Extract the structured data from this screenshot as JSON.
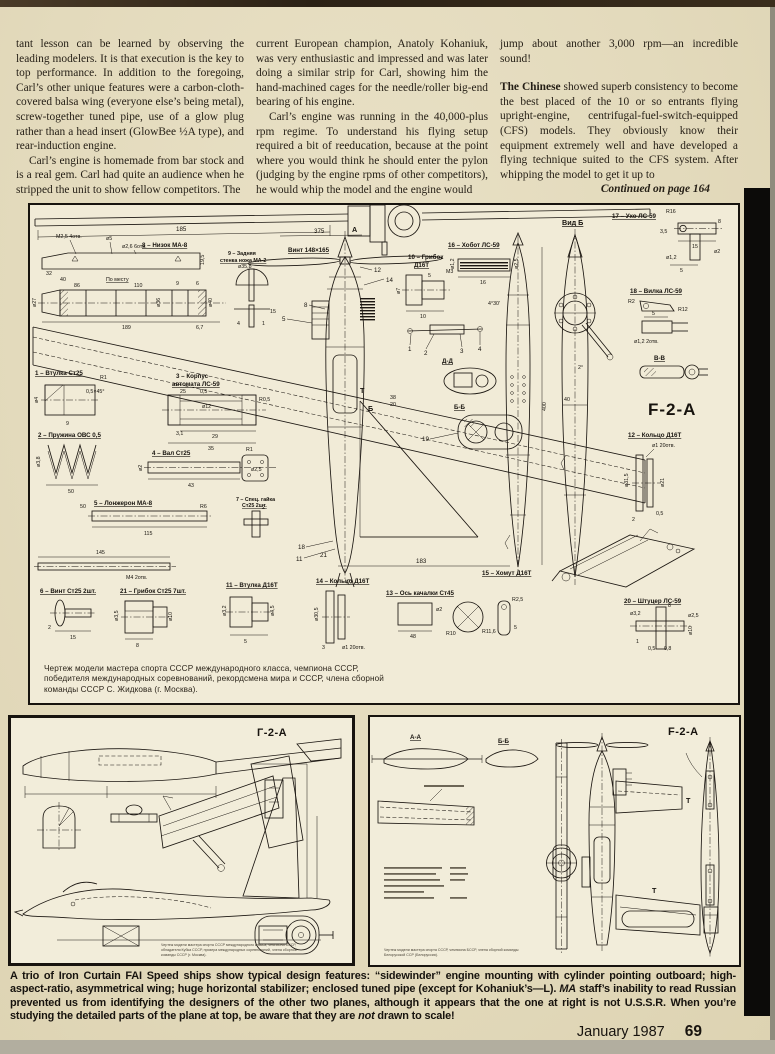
{
  "colors": {
    "paper": "#e3dabc",
    "ink": "#17130e",
    "box_bg": "#f1ebd7",
    "edge_black": "#0c0b09",
    "edge_gray": "#b2ae9f"
  },
  "art": {
    "c1p1": "tant lesson can be learned by observing the leading modelers. It is that execution is the key to top performance. In addition to the foregoing, Carl’s other unique features were a carbon-cloth-covered balsa wing (everyone else’s being metal), screw-together tuned pipe, use of a glow plug rather than a head insert (GlowBee ½A type), and rear-induction engine.",
    "c1p2": "Carl’s engine is homemade from bar stock and is a real gem. Carl had quite an audience when he stripped the unit to show fellow competitors. The",
    "c2p1": "current European champion, Anatoly Kohaniuk, was very enthusiastic and impressed and was later doing a similar strip for Carl, showing him the hand-machined cages for the needle/roller big-end bearing of his engine.",
    "c2p2": "Carl’s engine was running in the 40,000-plus rpm regime. To understand his flying setup required a bit of reeducation, because at the point where you would think he should enter the pylon (judging by the engine rpms of other competitors), he would whip the model and the engine would",
    "c3p1": "jump about another 3,000 rpm—an incredible sound!",
    "c3lead": "The Chinese",
    "c3p2": " showed superb consistency to become the best placed of the 10 or so entrants flying upright-engine, centrifugal-fuel-switch-equipped (CFS) models. They obviously know their equipment extremely well and have developed a flying technique suited to the CFS system. After whipping the model to get it up to",
    "continued": "Continued on page 164"
  },
  "md": {
    "title": "F-2-A",
    "prop": "Винт 148×165",
    "cap1": "Чертеж модели мастера спорта СССР международного класса, чемпиона СССР,",
    "cap2": "победителя международных соревнований, рекордсмена мира и СССР, члена сборной",
    "cap3": "команды СССР С. Жидкова (г. Москва).",
    "views": {
      "vid_b": "Вид Б",
      "bb": "Б-Б",
      "vv": "В-В",
      "dd": "Д-Д",
      "a": "А",
      "b": "Б",
      "t": "Т"
    },
    "parts": {
      "p1": "1 – Втулка Ст25",
      "p2": "2 – Пружина ОВС 0,5",
      "p3a": "3 – Корпус",
      "p3b": "автомата ЛС-59",
      "p4": "4 – Вал Ст25",
      "p5": "5 – Лонжерон МА-8",
      "p6": "6 – Винт Ст25 2шт.",
      "p7a": "7 – Спец. гайка",
      "p7b": "Ст25 2шт.",
      "p8": "8 – Низок МА-8",
      "p9a": "9 – Задняя",
      "p9b": "стенка ножа МА-2",
      "p10a": "10 – Грибок",
      "p10b": "Д16Т",
      "p11": "11 – Втулка Д16Т",
      "p12": "12 – Кольцо Д16Т",
      "p13": "13 – Ось качалки Ст45",
      "p14": "14 – Кольцо Д16Т",
      "p15": "15 – Хомут Д16Т",
      "p16": "16 – Хобот ЛС-59",
      "p17": "17 – Ухо ЛС-59",
      "p18": "18 – Вилка ЛС-59",
      "p20": "20 – Штуцер ЛС-59",
      "p21": "21 – Грибок Ст25 7шт."
    },
    "dims": {
      "d185": "185",
      "d375": "375",
      "d110": "110",
      "d86": "86",
      "d40": "40",
      "d32": "32",
      "d9": "9",
      "d6": "6",
      "d189": "189",
      "d67": "6,7",
      "d195": "19,5",
      "d25": "25",
      "d05": "0,5",
      "d29": "29",
      "d35": "35",
      "d31": "3,1",
      "d43": "43",
      "d50": "50",
      "d115": "115",
      "d145": "145",
      "d183": "183",
      "d400": "400",
      "d38": "38",
      "d20": "20",
      "d48": "48",
      "d16": "16",
      "d15": "15",
      "d8": "8",
      "d5": "5",
      "d10": "10",
      "d4": "4",
      "d3": "3",
      "d2": "2",
      "d1": "1",
      "d35c": "3,5",
      "d08": "0,8"
    },
    "misc": {
      "m25_4": "М2,5 4отв.",
      "o5": "ø5",
      "o26_6": "ø2,6 6отв.",
      "o358": "ø35,8",
      "m3": "М3",
      "m4_2": "М4 2отв.",
      "o12": "ø12",
      "o12s": "ø1,2",
      "o25s": "ø2,5",
      "o2": "ø2",
      "o7": "ø7",
      "o27": "ø27",
      "o36": "ø36",
      "o40": "ø40",
      "o38s": "ø3,8",
      "o35s": "ø3,5",
      "o32s": "ø3,2",
      "o45": "ø4,5",
      "o315": "ø31,5",
      "o305": "ø30,5",
      "o21": "ø21",
      "o1_20": "ø1 20отв.",
      "o12_2": "ø1,2 2отв.",
      "o10": "ø10",
      "o4": "ø4",
      "r1": "R1",
      "r2": "R2",
      "r25": "R2,5",
      "r05": "R0,5",
      "r6": "R6",
      "r10": "R10",
      "r116": "R11,6",
      "r12": "R12",
      "r16": "R16",
      "deg430": "4°30′",
      "deg2": "2°",
      "q45": "0,5×45°",
      "po": "По месту"
    },
    "nums": {
      "n1": "1",
      "n2": "2",
      "n3": "3",
      "n4": "4",
      "n5": "5",
      "n8": "8",
      "n11": "11",
      "n12": "12",
      "n13": "13",
      "n14": "14",
      "n15": "15",
      "n16": "16",
      "n18": "18",
      "n19": "19",
      "n21": "21"
    }
  },
  "ld": {
    "title": "Г-2-А",
    "cap1": "Чертеж модели мастера спорта СССР международного класса, чемпиона СССР,",
    "cap2": "обладателя Кубка СССР, призера международных соревнований, члена сборной",
    "cap3": "команды СССР (г. Москва)."
  },
  "rd": {
    "title": "F-2-A",
    "aa": "А-А",
    "bb": "Б-Б",
    "t1": "Т",
    "t2": "Т",
    "cap1": "Чертеж модели мастера спорта СССР, чемпиона БССР, члена сборной команды",
    "cap2": "Белорусской ССР (Белоруссия)."
  },
  "cap": {
    "p1": "A trio of Iron Curtain FAI Speed ships show typical design features: “sidewinder” engine mounting with cylinder pointing outboard; high-aspect-ratio, asymmetrical wing; huge horizontal stabilizer; enclosed tuned pipe (except for Kohaniuk’s—L). ",
    "ma": "MA",
    "p2": " staff’s inability to read Russian prevented us from identifying the designers of the other two planes, although it appears that the one at right is not U.S.S.R. When you’re studying the detailed parts of the plane at top, be aware that they are ",
    "notw": "not",
    "p3": " drawn to scale!"
  },
  "ftr": {
    "date": "January 1987",
    "page": "69"
  }
}
